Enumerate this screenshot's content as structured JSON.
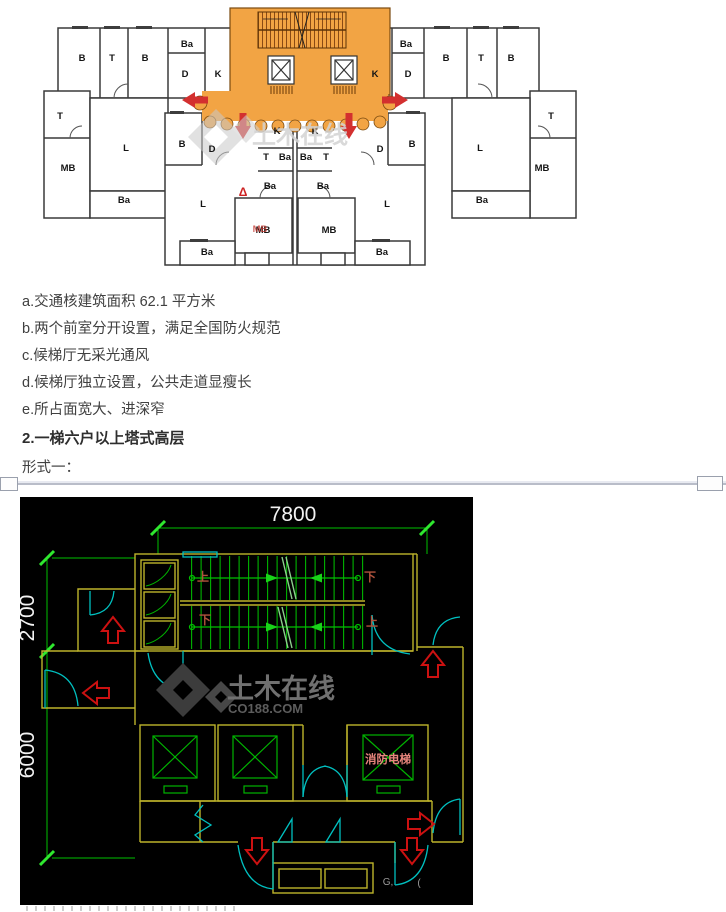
{
  "document": {
    "list_items": [
      "a.交通核建筑面积 62.1 平方米",
      "b.两个前室分开设置，满足全国防火规范",
      "c.候梯厅无采光通风",
      "d.候梯厅独立设置，公共走道显瘦长",
      "e.所占面宽大、进深窄"
    ],
    "heading": "2.一梯六户以上塔式高层",
    "subheading": "形式一："
  },
  "plan1": {
    "colors": {
      "core_orange": "#F2A444",
      "arrow_red": "#D3302F",
      "wall": "#3a3a3a"
    },
    "labels": [
      {
        "t": "B",
        "x": 52,
        "y": 58
      },
      {
        "t": "T",
        "x": 82,
        "y": 58
      },
      {
        "t": "B",
        "x": 115,
        "y": 58
      },
      {
        "t": "Ba",
        "x": 157,
        "y": 44
      },
      {
        "t": "D",
        "x": 155,
        "y": 74
      },
      {
        "t": "K",
        "x": 188,
        "y": 74
      },
      {
        "t": "K",
        "x": 345,
        "y": 74
      },
      {
        "t": "Ba",
        "x": 376,
        "y": 44
      },
      {
        "t": "D",
        "x": 378,
        "y": 74
      },
      {
        "t": "B",
        "x": 416,
        "y": 58
      },
      {
        "t": "T",
        "x": 451,
        "y": 58
      },
      {
        "t": "B",
        "x": 481,
        "y": 58
      },
      {
        "t": "T",
        "x": 30,
        "y": 116
      },
      {
        "t": "MB",
        "x": 38,
        "y": 168
      },
      {
        "t": "L",
        "x": 96,
        "y": 148
      },
      {
        "t": "Ba",
        "x": 94,
        "y": 200
      },
      {
        "t": "T",
        "x": 521,
        "y": 116
      },
      {
        "t": "MB",
        "x": 512,
        "y": 168
      },
      {
        "t": "L",
        "x": 450,
        "y": 148
      },
      {
        "t": "Ba",
        "x": 452,
        "y": 200
      },
      {
        "t": "K",
        "x": 247,
        "y": 131
      },
      {
        "t": "K",
        "x": 285,
        "y": 131
      },
      {
        "t": "T",
        "x": 236,
        "y": 157
      },
      {
        "t": "Ba",
        "x": 255,
        "y": 157
      },
      {
        "t": "Ba",
        "x": 276,
        "y": 157
      },
      {
        "t": "T",
        "x": 296,
        "y": 157
      },
      {
        "t": "Ba",
        "x": 240,
        "y": 186
      },
      {
        "t": "Ba",
        "x": 293,
        "y": 186
      },
      {
        "t": "B",
        "x": 152,
        "y": 144
      },
      {
        "t": "D",
        "x": 182,
        "y": 149
      },
      {
        "t": "D",
        "x": 350,
        "y": 149
      },
      {
        "t": "B",
        "x": 382,
        "y": 144
      },
      {
        "t": "L",
        "x": 173,
        "y": 204
      },
      {
        "t": "L",
        "x": 357,
        "y": 204
      },
      {
        "t": "MB",
        "x": 233,
        "y": 230
      },
      {
        "t": "MB",
        "x": 299,
        "y": 230
      },
      {
        "t": "Ba",
        "x": 177,
        "y": 252
      },
      {
        "t": "Ba",
        "x": 352,
        "y": 252
      },
      {
        "t": "土木在线",
        "x": 222,
        "y": 140,
        "c": "#d3d3d3",
        "s": 24,
        "w": "bold",
        "a": "start",
        "o": 0.85,
        "n": "plan1-watermark-text"
      },
      {
        "t": "MB",
        "x": 230,
        "y": 229,
        "c": "#c03028",
        "s": 9.5,
        "w": "bold",
        "o": 0.75,
        "n": "red-stamp-annotation"
      },
      {
        "t": "Δ",
        "x": 213,
        "y": 193,
        "c": "#cc2222",
        "s": 12,
        "w": "bold",
        "n": "red-triangle-annotation"
      }
    ]
  },
  "plan2": {
    "colors": {
      "wall_yellow": "#bdb32b",
      "line_green": "#00c000",
      "door_cyan": "#00c0c0",
      "arrow_red": "#cc1111",
      "dim_text": "#f2f2f2",
      "fire_label": "#e8867d"
    },
    "labels": [
      {
        "t": "7800",
        "x": 273,
        "y": 24,
        "c": "#f2f2f2",
        "s": 21,
        "w": "normal",
        "n": "dim-top-7800"
      },
      {
        "t": "2700",
        "x": 14,
        "y": 121,
        "c": "#f2f2f2",
        "s": 21,
        "w": "normal",
        "r": -90,
        "n": "dim-left-2700"
      },
      {
        "t": "6000",
        "x": 14,
        "y": 258,
        "c": "#f2f2f2",
        "s": 21,
        "w": "normal",
        "r": -90,
        "n": "dim-left-6000"
      },
      {
        "t": "上",
        "x": 183,
        "y": 84,
        "n": "stair-up-label"
      },
      {
        "t": "下",
        "x": 350,
        "y": 84,
        "n": "stair-down-label"
      },
      {
        "t": "下",
        "x": 185,
        "y": 127,
        "n": "stair-down-label"
      },
      {
        "t": "上",
        "x": 352,
        "y": 129,
        "n": "stair-up-label"
      },
      {
        "t": "消防电梯",
        "x": 368,
        "y": 266,
        "c": "#e8867d",
        "s": 11.5,
        "n": "fire-elevator-label"
      },
      {
        "t": "土木在线",
        "x": 207,
        "y": 201,
        "c": "#707070",
        "s": 27,
        "w": "bold",
        "a": "start",
        "n": "watermark-text"
      },
      {
        "t": "CO188.COM",
        "x": 208,
        "y": 216,
        "c": "#5d5d5d",
        "s": 13,
        "w": "bold",
        "a": "start",
        "n": "watermark-url"
      },
      {
        "t": "G,",
        "x": 368,
        "y": 388,
        "c": "#9a9a9a",
        "s": 10,
        "w": "normal",
        "n": "watermark-fragment"
      },
      {
        "t": "(",
        "x": 399,
        "y": 389,
        "c": "#9a9a9a",
        "s": 10,
        "w": "normal",
        "n": "watermark-fragment"
      }
    ]
  }
}
